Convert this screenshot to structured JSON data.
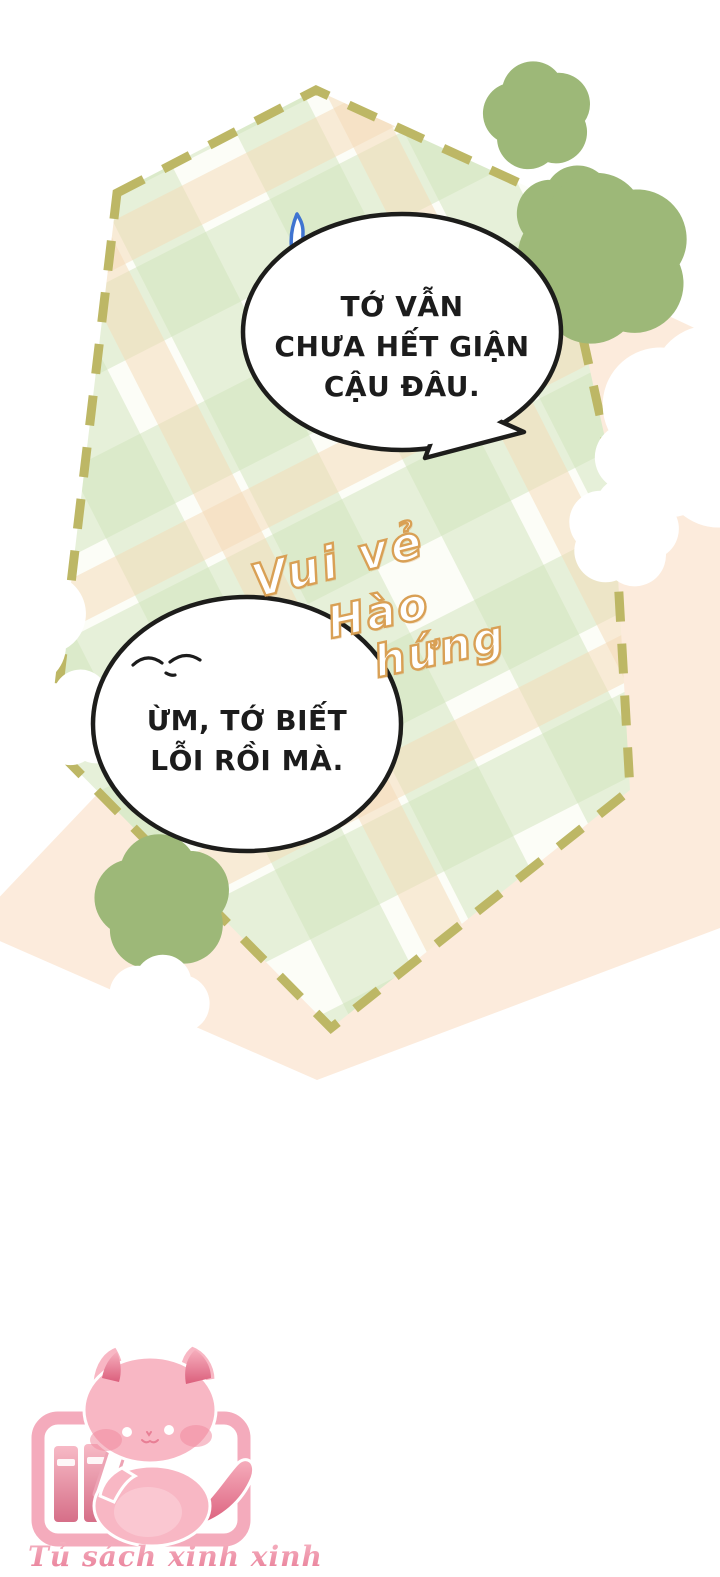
{
  "speech": {
    "bubble1": {
      "lines": [
        "TỚ VẪN",
        "CHƯA HẾT GIẬN",
        "CẬU ĐÂU."
      ]
    },
    "bubble2": {
      "lines": [
        "ỪM, TỚ BIẾT",
        "LỖI RỒI MÀ."
      ]
    }
  },
  "sfx": {
    "words": [
      "Vui vẻ",
      "Hào",
      "hứng"
    ]
  },
  "watermark": {
    "text": "Tủ sách xinh xinh"
  },
  "decorations": {
    "panel": "gingham-plaid-panel",
    "backdrop": "peach-diamond-backdrop",
    "stars_outline": "green-outline-star-icon",
    "stars_filled": "cream-star-icon",
    "accent": "blue-comma-accent",
    "mascot": "pink-cat-mascot",
    "bookshelf": "bookshelf-icon",
    "pencil": "pencil-icon"
  },
  "colors": {
    "page_bg": "#ffffff",
    "plaid_base": "#fcfdf7",
    "plaid_green": "#cfe3bc",
    "plaid_peach": "#f3d9b5",
    "dash_border": "#bdb765",
    "peach_backdrop": "#fcebdc",
    "star_cream": "#f6e0ab",
    "star_outline_green": "#9db878",
    "accent_blue": "#3f74d1",
    "sfx_outline_orange": "#d9a055",
    "bubble_border": "#1d1d1b",
    "text_black": "#1c1c1c",
    "mascot_pink": "#f8b7c4",
    "mascot_rose": "#db5f7c",
    "mascot_frame_pink": "#f4abbc",
    "watermark_pink_dark": "#e87c96",
    "watermark_pink_light": "#f6b4c3"
  }
}
